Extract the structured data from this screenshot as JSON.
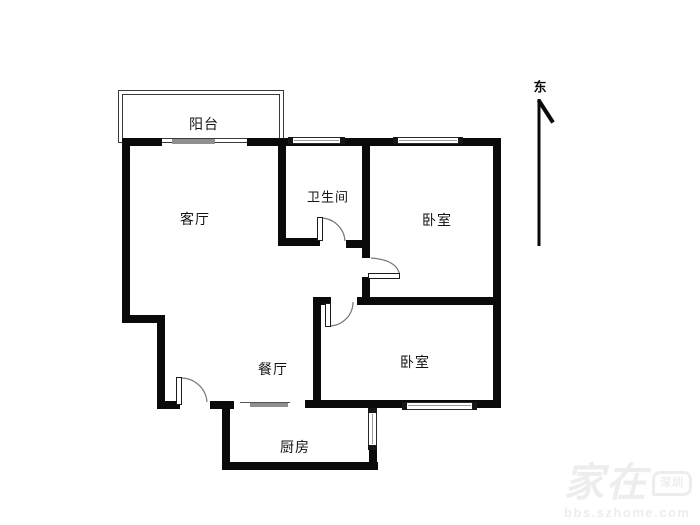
{
  "canvas": {
    "width": 700,
    "height": 525,
    "background": "#ffffff",
    "wall_color": "#0a0a0a"
  },
  "rooms": [
    {
      "id": "balcony",
      "label": "阳台"
    },
    {
      "id": "living-room",
      "label": "客厅"
    },
    {
      "id": "bathroom",
      "label": "卫生间"
    },
    {
      "id": "bedroom-north",
      "label": "卧室"
    },
    {
      "id": "bedroom-south",
      "label": "卧室"
    },
    {
      "id": "dining-room",
      "label": "餐厅"
    },
    {
      "id": "kitchen",
      "label": "厨房"
    }
  ],
  "compass": {
    "label": "东"
  },
  "watermark": {
    "brand": "家在",
    "badge": "深圳",
    "site": "bbs.szhome.com"
  }
}
